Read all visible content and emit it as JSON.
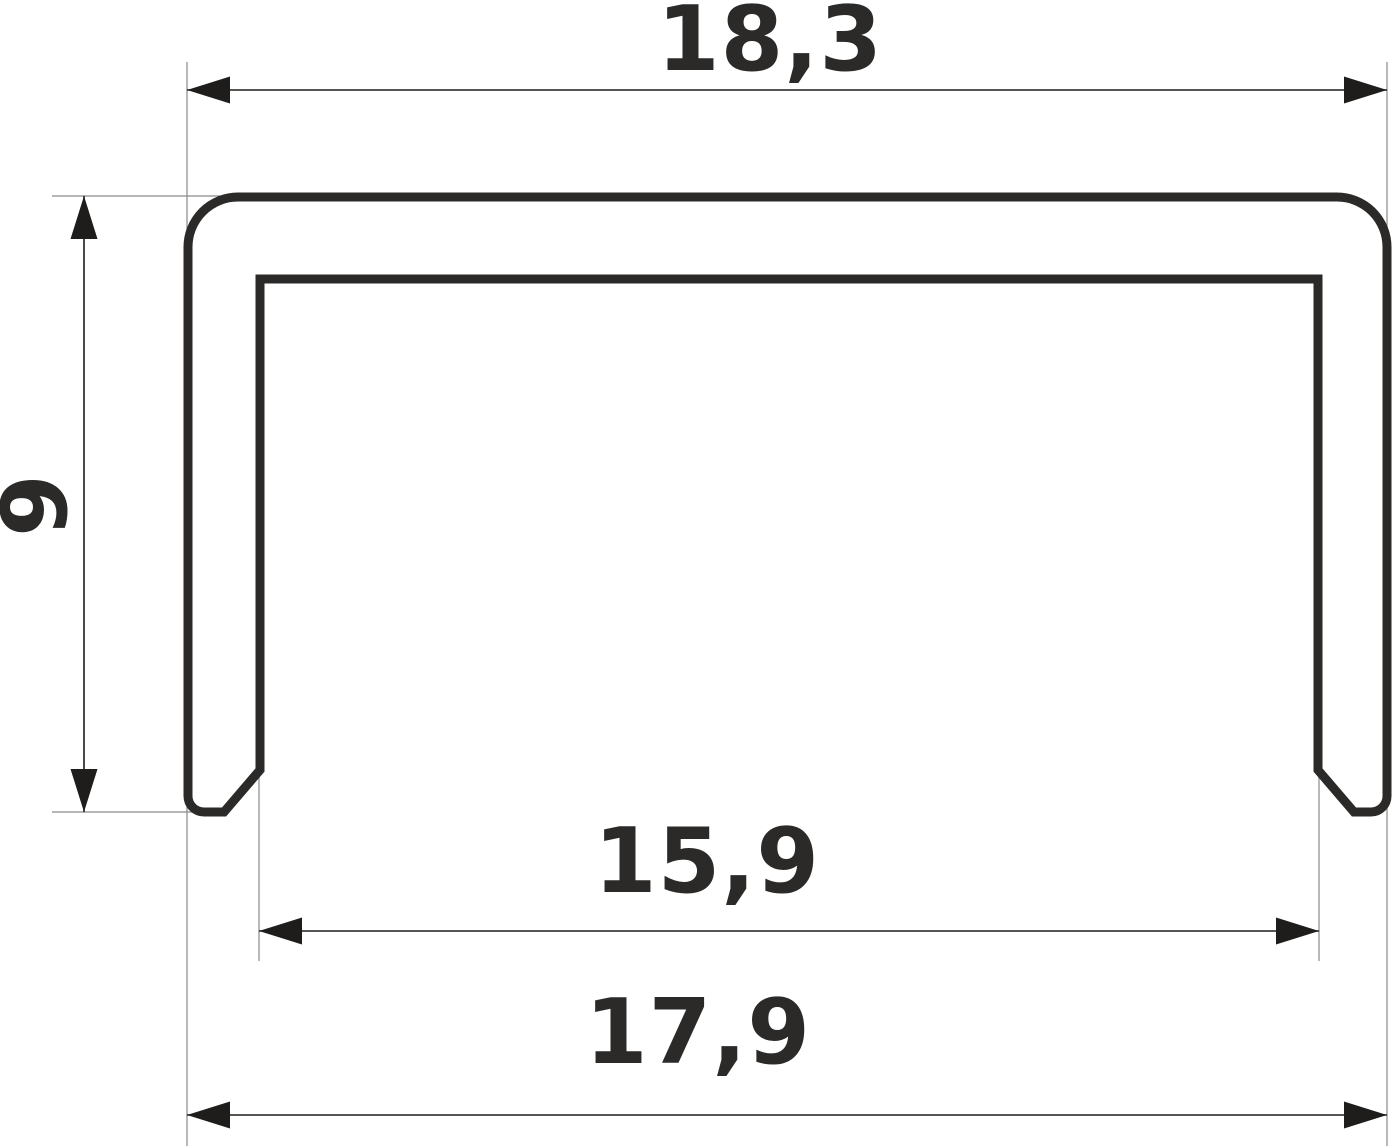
{
  "drawing": {
    "type": "technical-cross-section",
    "subject": "u-channel-profile",
    "dimensions": {
      "top_width": {
        "label": "18,3",
        "value": 18.3,
        "orientation": "horizontal",
        "position": "top"
      },
      "height": {
        "label": "9",
        "value": 9,
        "orientation": "vertical",
        "position": "left"
      },
      "inner_width": {
        "label": "15,9",
        "value": 15.9,
        "orientation": "horizontal",
        "position": "below-profile"
      },
      "bottom_width": {
        "label": "17,9",
        "value": 17.9,
        "orientation": "horizontal",
        "position": "bottom"
      }
    }
  },
  "colors": {
    "outline": "#2b2a28",
    "dimension": "#1e1d1c",
    "extension": "#8a8a8a",
    "text": "#2b2a29",
    "background": "#ffffff"
  }
}
